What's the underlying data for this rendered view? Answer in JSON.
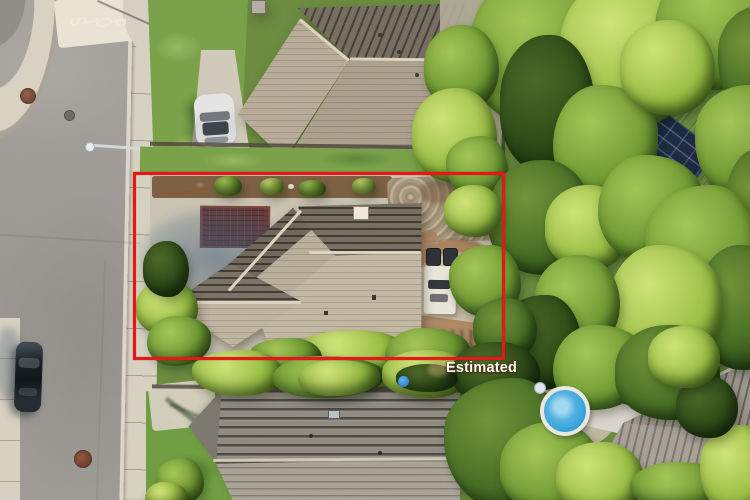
{
  "overlay": {
    "boundary_label": "Estimated",
    "boundary_color": "#e81616",
    "label_color": "#ffffff"
  },
  "road": {
    "stop_marking": "STOP",
    "marking_color": "#edeadf"
  },
  "palette": {
    "asphalt": "#a09d97",
    "sidewalk": "#d6d0c1",
    "concrete": "#c9c2b1",
    "shadow_blue": "#5c7fa0",
    "brick_inlay": "#643a38",
    "roof_tan_light": "#c1b7a2",
    "roof_tan_dark": "#756c60",
    "roof_gray": "#9b958b",
    "lawn_green": "#78a048",
    "tree_bright": "#9abf45",
    "tree_dark": "#2e4a17",
    "solar_navy": "#1e2a42",
    "pool_blue": "#2e9cd6",
    "car_black": "#1a1f24",
    "car_silver": "#d8d9da",
    "mulch_brown": "#7b5f43",
    "patio_brick": "#a8815c"
  }
}
